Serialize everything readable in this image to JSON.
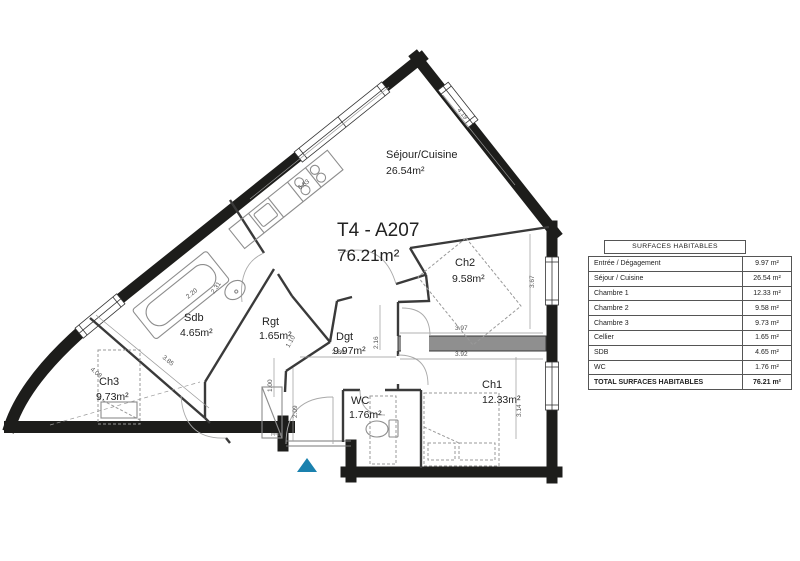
{
  "plan": {
    "unit": {
      "title": "T4 - A207",
      "area": "76.21m²"
    },
    "rooms": {
      "sejour": {
        "name": "Séjour/Cuisine",
        "area": "26.54m²"
      },
      "ch1": {
        "name": "Ch1",
        "area": "12.33m²"
      },
      "ch2": {
        "name": "Ch2",
        "area": "9.58m²"
      },
      "ch3": {
        "name": "Ch3",
        "area": "9.73m²"
      },
      "sdb": {
        "name": "Sdb",
        "area": "4.65m²"
      },
      "rgt": {
        "name": "Rgt",
        "area": "1.65m²"
      },
      "dgt": {
        "name": "Dgt",
        "area": "9.97m²"
      },
      "wc": {
        "name": "WC",
        "area": "1.76m²"
      }
    },
    "dims": {
      "d683": "6.83",
      "d419": "4.19",
      "d367": "3.67",
      "d314": "3.14",
      "d397": "3.97",
      "d392": "3.92",
      "d286": "2.86",
      "d216": "2.16",
      "d220": "2.20",
      "d231": "2.31",
      "d110": "1.10",
      "d100": "1.00",
      "d209": "2.09",
      "d385": "3.85",
      "d408": "4.08"
    },
    "entry_door_code": "PP93",
    "colors": {
      "entrance_marker": "#1a81ae",
      "wall": "#1d1d1b"
    }
  },
  "table": {
    "title": "SURFACES HABITABLES",
    "rows": [
      {
        "label": "Entrée / Dégagement",
        "value": "9.97 m²"
      },
      {
        "label": "Séjour / Cuisine",
        "value": "26.54 m²"
      },
      {
        "label": "Chambre 1",
        "value": "12.33 m²"
      },
      {
        "label": "Chambre 2",
        "value": "9.58 m²"
      },
      {
        "label": "Chambre 3",
        "value": "9.73 m²"
      },
      {
        "label": "Cellier",
        "value": "1.65 m²"
      },
      {
        "label": "SDB",
        "value": "4.65 m²"
      },
      {
        "label": "WC",
        "value": "1.76 m²"
      }
    ],
    "total": {
      "label": "TOTAL SURFACES HABITABLES",
      "value": "76.21 m²"
    }
  }
}
